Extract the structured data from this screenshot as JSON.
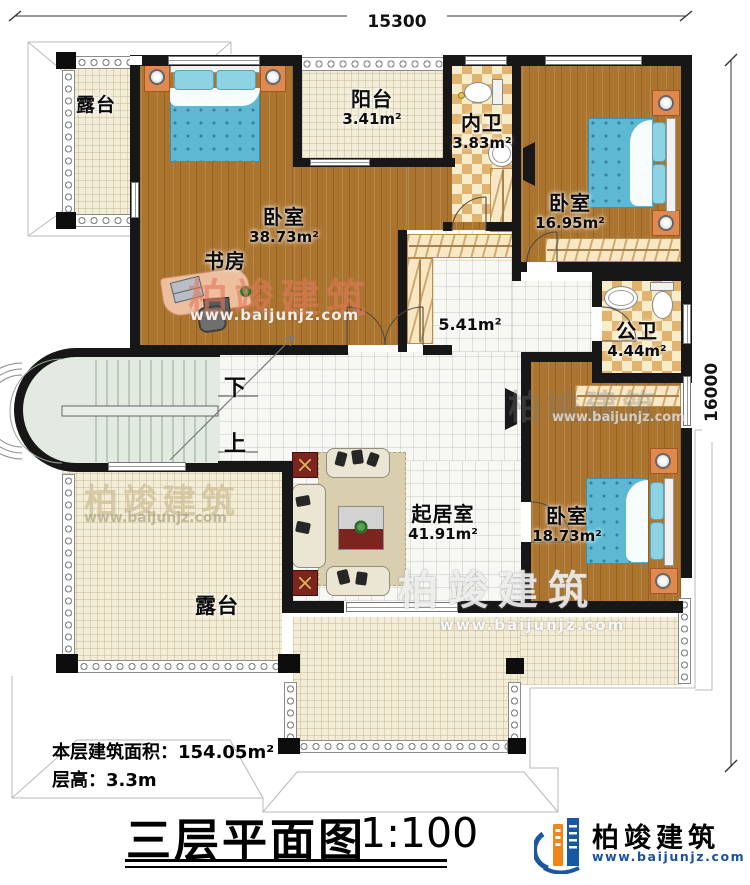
{
  "dimensions": {
    "top": "15300",
    "right": "16000"
  },
  "rooms": {
    "terrace_top": {
      "name": "露台"
    },
    "master_bedroom": {
      "name": "卧室",
      "area": "38.73m²"
    },
    "study": {
      "name": "书房"
    },
    "balcony": {
      "name": "阳台",
      "area": "3.41m²"
    },
    "ensuite_bath": {
      "name": "内卫",
      "area": "3.83m²"
    },
    "bedroom_ne": {
      "name": "卧室",
      "area": "16.95m²"
    },
    "hallway": {
      "area": "5.41m²"
    },
    "shared_bath": {
      "name": "公卫",
      "area": "4.44m²"
    },
    "living_room": {
      "name": "起居室",
      "area": "41.91m²"
    },
    "bedroom_se": {
      "name": "卧室",
      "area": "18.73m²"
    },
    "terrace_main": {
      "name": "露台"
    }
  },
  "stairs": {
    "down": "下",
    "up": "上"
  },
  "footer": {
    "area_label": "本层建筑面积：154.05m²",
    "floor_height_label": "层高：3.3m",
    "title": "三层平面图",
    "scale": "1:100"
  },
  "branding": {
    "company": "柏竣建筑",
    "website": "www.baijunjz.com"
  },
  "watermark": {
    "company": "柏竣建筑",
    "website": "www.baijunjz.com"
  },
  "colors": {
    "wall": "#171717",
    "wood_floor": "#ac752f",
    "tile_cream": "#f3edd8",
    "bath_checker": "#e2b36e",
    "bed_blue": "#5cb8d3",
    "stair_green": "#e3eae2",
    "logo_blue": "#1857a4",
    "logo_orange": "#f08519",
    "accent_dark_red": "#7c241e"
  }
}
